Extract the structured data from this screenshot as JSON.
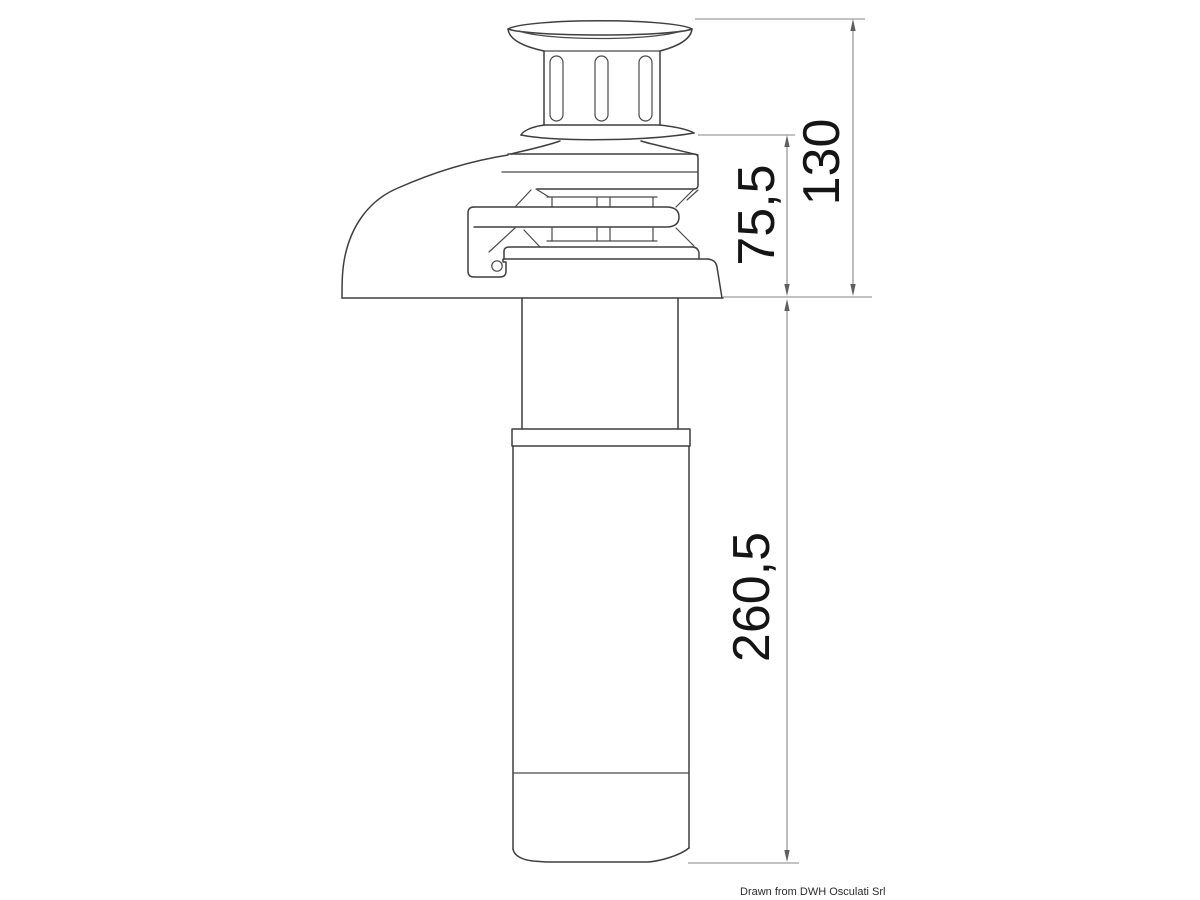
{
  "page": {
    "background_color": "#ffffff",
    "credit": "Drawn from DWH Osculati Srl"
  },
  "drawing": {
    "colors": {
      "outline": "#3f3f3f",
      "dimension_lines": "#858585",
      "dimension_arrows": "#5f5f5f",
      "dimension_text": "#151515"
    },
    "dimensions": [
      {
        "name": "overall-height-above-deck",
        "value": "130"
      },
      {
        "name": "gypsy-stack-height",
        "value": "75,5"
      },
      {
        "name": "below-deck-tube-length",
        "value": "260,5"
      }
    ]
  }
}
